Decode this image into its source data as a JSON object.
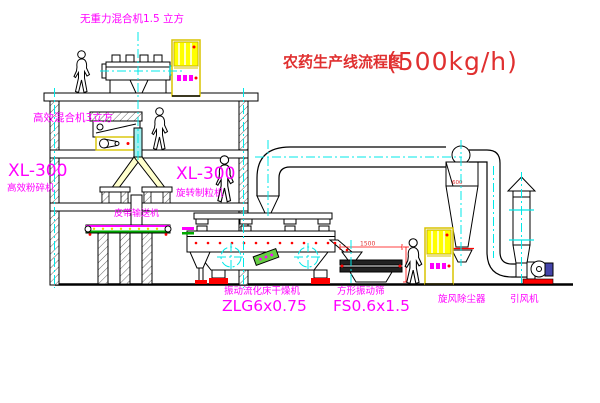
{
  "title": {
    "text": "农药生产线流程图",
    "capacity": "(500kg/h)",
    "color": "#e03030"
  },
  "colors": {
    "line": "#000000",
    "label_magenta": "#ff00ff",
    "centerline_cyan": "#00e8e8",
    "cabinet_yellow": "#ffff00",
    "accent_red": "#ff0000",
    "belt_green": "#00aa00"
  },
  "equipment": {
    "gravity_mixer": {
      "label": "无重力混合机1.5 立方"
    },
    "mixer_2f": {
      "label": "高效混合机3立方"
    },
    "pulverizer": {
      "model": "XL-300",
      "name": "高效粉碎机"
    },
    "granulator": {
      "model": "XL-300",
      "name": "旋转制粒机"
    },
    "belt_conveyor": {
      "name": "皮带输送机"
    },
    "dryer": {
      "name": "振动流化床干燥机",
      "model": "ZLG6x0.75"
    },
    "sieve": {
      "name": "方形振动筛",
      "model": "FS0.6x1.5",
      "dim_width": "1500"
    },
    "cyclone": {
      "name": "旋风除尘器",
      "dim": "600"
    },
    "fan": {
      "name": "引风机"
    }
  }
}
